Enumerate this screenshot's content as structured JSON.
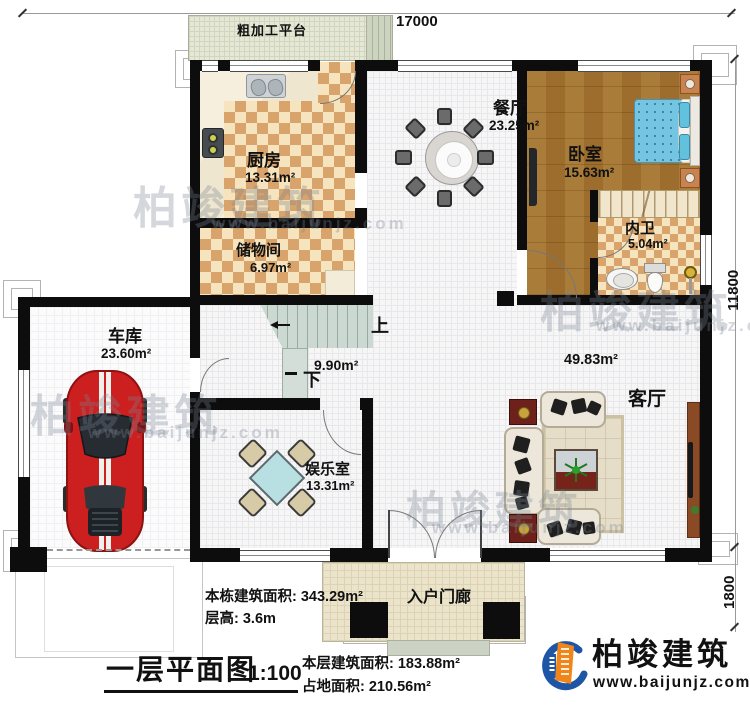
{
  "plan": {
    "platform": {
      "label": "粗加工平台"
    },
    "dims": {
      "top": "17000",
      "right": "11800",
      "right_lower": "1800"
    },
    "rooms": {
      "kitchen": {
        "name": "厨房",
        "area": "13.31m²"
      },
      "storage": {
        "name": "储物间",
        "area": "6.97m²"
      },
      "dining": {
        "name": "餐厅",
        "area": "23.25m²"
      },
      "bedroom": {
        "name": "卧室",
        "area": "15.63m²"
      },
      "bathroom": {
        "name": "内卫",
        "area": "5.04m²"
      },
      "garage": {
        "name": "车库",
        "area": "23.60m²"
      },
      "entertainment": {
        "name": "娱乐室",
        "area": "13.31m²"
      },
      "living": {
        "name": "客厅",
        "area": "49.83m²"
      },
      "porch": {
        "name": "入户门廊"
      },
      "stairs": {
        "area": "9.90m²",
        "up_label": "上",
        "down_label": "下"
      }
    }
  },
  "title_block": {
    "building_total_area": "本栋建筑面积: 343.29m²",
    "floor_height": "层高: 3.6m",
    "plan_title": "一层平面图",
    "scale": "1:100",
    "floor_area": "本层建筑面积: 183.88m²",
    "footprint": "占地面积: 210.56m²"
  },
  "brand": {
    "name": "柏竣建筑",
    "website": "www.baijunjz.com"
  },
  "watermark": {
    "text": "柏竣建筑",
    "website": "www.baijunjz.com"
  },
  "colors": {
    "wall": "#0d0d0d",
    "brand_blue": "#1f55a5",
    "brand_orange": "#f08519",
    "bed_blue": "#74c5e1",
    "car_red": "#cc1f1f"
  }
}
